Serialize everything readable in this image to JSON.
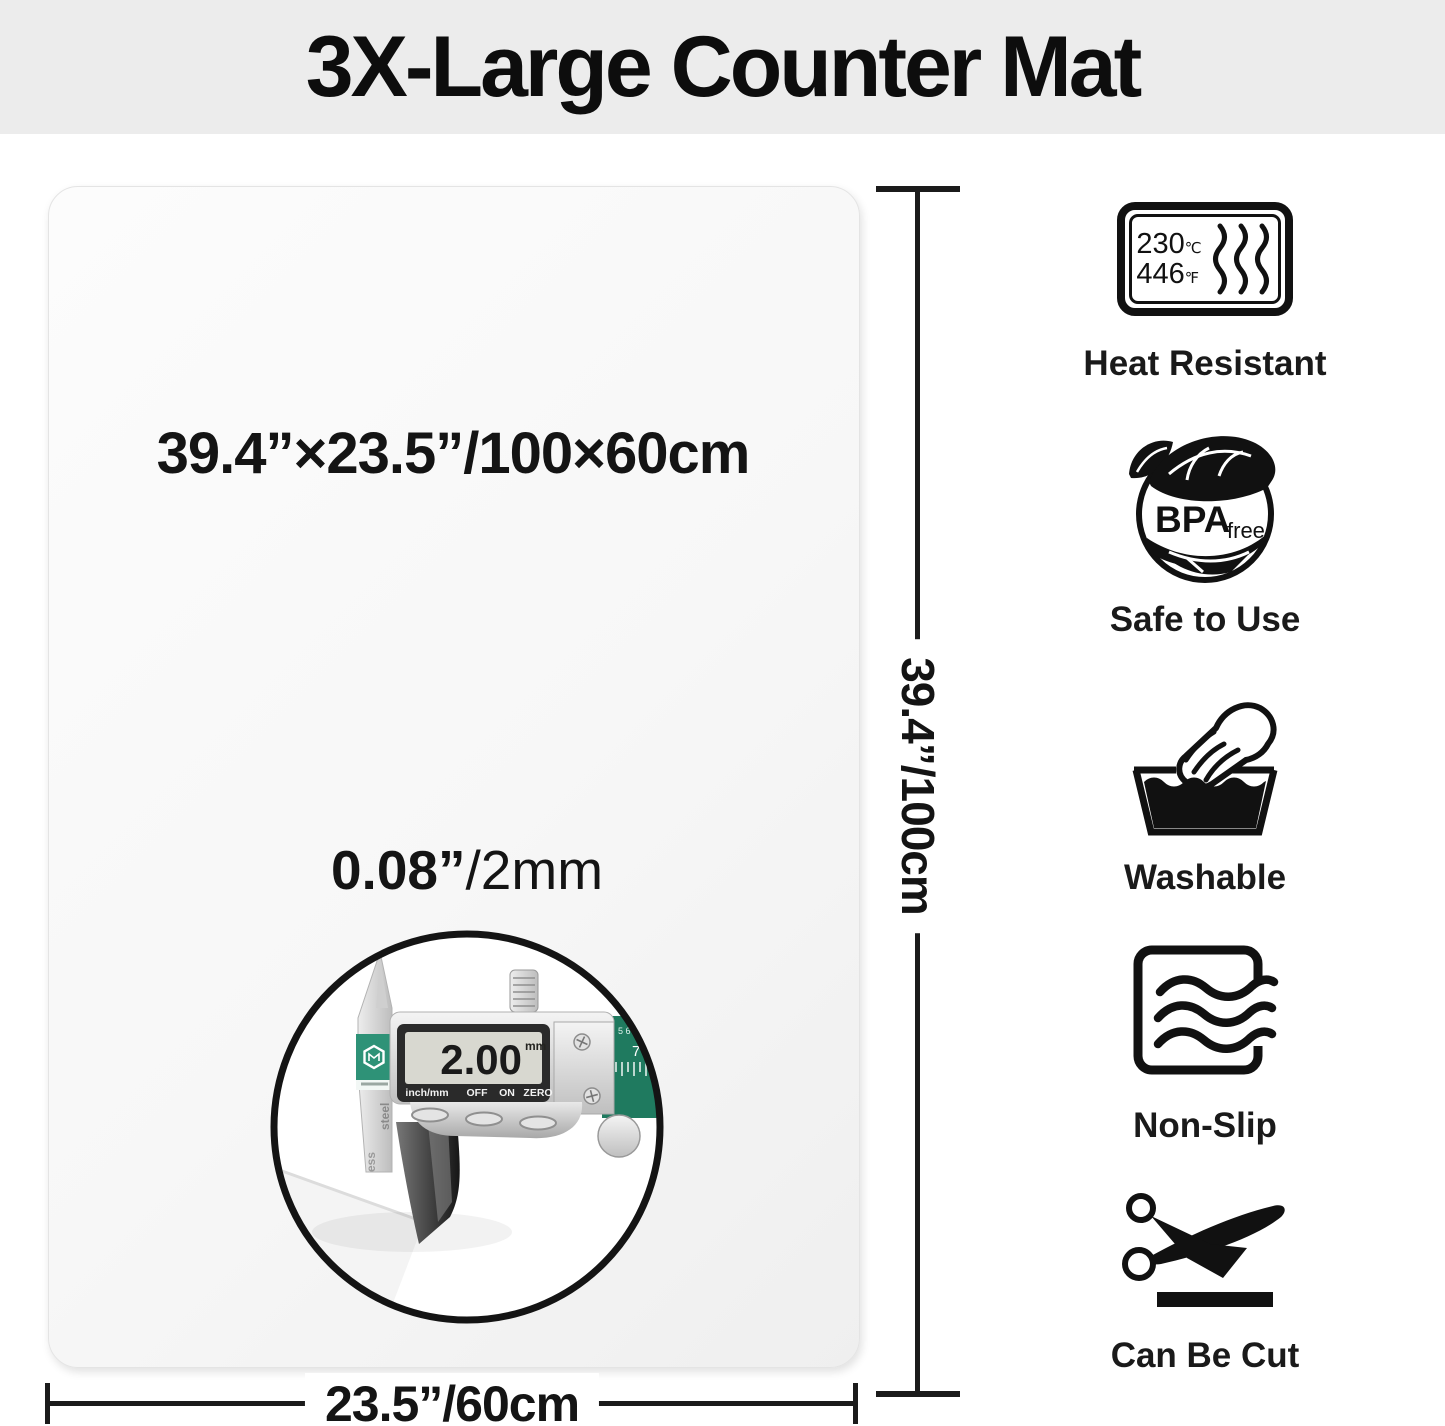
{
  "header": {
    "title": "3X-Large Counter Mat"
  },
  "mat": {
    "size_label": "39.4”×23.5”/100×60cm",
    "thickness_label_bold": "0.08”",
    "thickness_label_rest": "/2mm"
  },
  "dimension_lines": {
    "height_label": "39.4”/100cm",
    "width_label": "23.5”/60cm"
  },
  "inset": {
    "caliper_reading": "2.00",
    "caliper_unit": "mm",
    "caliper_buttons": [
      "inch/mm",
      "OFF",
      "ON",
      "ZERO"
    ],
    "caliper_side_text": [
      "ess",
      "steel"
    ],
    "caliper_scale_numbers": [
      "5 6",
      "7"
    ]
  },
  "features": [
    {
      "id": "heat-resistant",
      "label": "Heat Resistant",
      "temp_c": "230",
      "temp_c_unit": "℃",
      "temp_f": "446",
      "temp_f_unit": "℉"
    },
    {
      "id": "bpa-free",
      "label": "Safe to Use",
      "badge_main": "BPA",
      "badge_sub": "free"
    },
    {
      "id": "washable",
      "label": "Washable"
    },
    {
      "id": "non-slip",
      "label": "Non-Slip"
    },
    {
      "id": "can-be-cut",
      "label": "Can Be Cut"
    }
  ],
  "colors": {
    "banner_bg": "#ececec",
    "caliper_green": "#2e9277",
    "ink": "#111111"
  }
}
